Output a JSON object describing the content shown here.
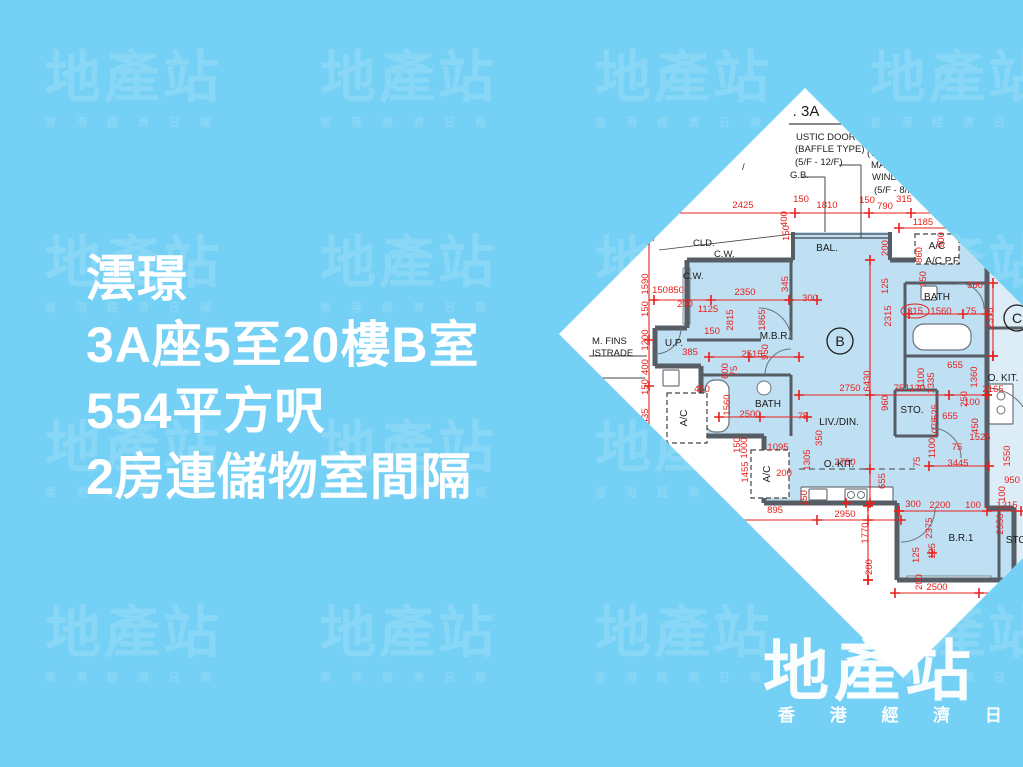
{
  "page": {
    "bg": "#75d0f5"
  },
  "watermark": {
    "logo": "地產站",
    "subtext": "香港經濟日報",
    "cols": [
      45,
      320,
      595,
      870
    ],
    "rows": [
      50,
      235,
      420,
      605
    ]
  },
  "headline": {
    "lines": [
      "澐璟",
      "3A座5至20樓B室",
      "554平方呎",
      "2房連儲物室間隔"
    ],
    "color": "#ffffff"
  },
  "brand": {
    "logo": "地產站",
    "subtext_spaced": "香 港 經 濟 日 報"
  },
  "floor_plan": {
    "colors": {
      "paper": "#ffffff",
      "unit_fill": "#bfdff2",
      "unitc_fill": "#dcedf8",
      "wall": "#565d64",
      "thin": "#444444",
      "red": "#e8211d",
      "text": "#1c1c1c",
      "fixture_fill": "#ffffff",
      "fixture_stroke": "#6a737a",
      "window_fill": "#e4f2fb"
    },
    "tower_label": ". 3A",
    "notes": [
      [
        "USTIC DOOR",
        237,
        52
      ],
      [
        "(BAFFLE TYPE)",
        236,
        64
      ],
      [
        "(5/F  -  12/F)",
        236,
        77
      ],
      [
        "F..",
        306,
        56
      ],
      [
        "(WIT..",
        308,
        68
      ],
      [
        "MAINTE..",
        312,
        80
      ],
      [
        "WINDOW)",
        313,
        92
      ],
      [
        "(5/F - 8/F)",
        315,
        105
      ],
      [
        "G.B.",
        231,
        90
      ],
      [
        "/",
        183,
        82
      ],
      [
        "CLD.",
        134,
        158
      ],
      [
        "C.W.",
        155,
        169
      ],
      [
        "C.W.",
        124,
        191
      ],
      [
        "M. FINS",
        33,
        256
      ],
      [
        "ISTRADE",
        33,
        268
      ]
    ],
    "room_labels": [
      [
        "BAL.",
        268,
        163,
        0
      ],
      [
        "A/C",
        378,
        161,
        0
      ],
      [
        "A/C P.F.",
        384,
        176,
        0
      ],
      [
        "BATH",
        378,
        212,
        0
      ],
      [
        "M.B.R.",
        216,
        251,
        0
      ],
      [
        "U.P.",
        115,
        258,
        0
      ],
      [
        "BATH",
        209,
        319,
        0
      ],
      [
        "LIV./DIN.",
        280,
        337,
        0
      ],
      [
        "STO.",
        353,
        325,
        0
      ],
      [
        "O. KIT.",
        444,
        293,
        0
      ],
      [
        "O. KIT.",
        280,
        379,
        0
      ],
      [
        "B.R.1",
        402,
        453,
        0
      ],
      [
        "STO",
        457,
        455,
        0
      ],
      [
        "A/C",
        128,
        330,
        1
      ],
      [
        "A/C",
        211,
        386,
        1
      ]
    ],
    "unit_circles": [
      [
        "B",
        281,
        253
      ],
      [
        "C",
        458,
        230
      ]
    ],
    "dims_h": [
      [
        "2425",
        184,
        120
      ],
      [
        "150",
        242,
        114
      ],
      [
        "1810",
        268,
        120
      ],
      [
        "150",
        308,
        115
      ],
      [
        "790",
        326,
        121
      ],
      [
        "315",
        345,
        114
      ],
      [
        "1185",
        364,
        137
      ],
      [
        "150",
        101,
        205
      ],
      [
        "850",
        117,
        205
      ],
      [
        "200",
        126,
        219
      ],
      [
        "1125",
        149,
        224
      ],
      [
        "2350",
        186,
        207
      ],
      [
        "300",
        251,
        213
      ],
      [
        "150",
        153,
        246
      ],
      [
        "385",
        131,
        267
      ],
      [
        "2515",
        193,
        269
      ],
      [
        "450",
        143,
        304
      ],
      [
        "2500",
        191,
        329
      ],
      [
        "75",
        244,
        331
      ],
      [
        "2750",
        291,
        303
      ],
      [
        "75",
        340,
        303
      ],
      [
        "1120",
        356,
        303
      ],
      [
        "655",
        396,
        280
      ],
      [
        "655",
        391,
        331
      ],
      [
        "2165",
        434,
        304
      ],
      [
        "100",
        413,
        317
      ],
      [
        "1525",
        421,
        352
      ],
      [
        "75",
        398,
        362
      ],
      [
        "3445",
        399,
        378
      ],
      [
        "2750",
        286,
        377
      ],
      [
        "1095",
        219,
        362
      ],
      [
        "200",
        225,
        388
      ],
      [
        "895",
        216,
        425
      ],
      [
        "2950",
        286,
        429
      ],
      [
        "300",
        354,
        419
      ],
      [
        "2200",
        381,
        420
      ],
      [
        "100",
        414,
        420
      ],
      [
        "1215",
        448,
        420
      ],
      [
        "950",
        453,
        395
      ],
      [
        "2500",
        378,
        502
      ],
      [
        "315",
        356,
        226
      ],
      [
        "1560",
        382,
        226
      ],
      [
        "75",
        412,
        226
      ],
      [
        "360",
        416,
        200
      ]
    ],
    "dims_v": [
      [
        "400",
        228,
        131
      ],
      [
        "150",
        230,
        145
      ],
      [
        "345",
        229,
        196
      ],
      [
        "900",
        385,
        152
      ],
      [
        "860",
        363,
        167
      ],
      [
        "150",
        367,
        191
      ],
      [
        "1590",
        89,
        196
      ],
      [
        "150",
        89,
        221
      ],
      [
        "1200",
        89,
        252
      ],
      [
        "400",
        89,
        279
      ],
      [
        "150",
        89,
        299
      ],
      [
        "1435",
        89,
        331
      ],
      [
        "2815",
        174,
        232
      ],
      [
        "1865",
        206,
        232
      ],
      [
        "200",
        329,
        160
      ],
      [
        "125",
        329,
        198
      ],
      [
        "2315",
        332,
        228
      ],
      [
        "2375",
        434,
        230
      ],
      [
        "950",
        209,
        264
      ],
      [
        "600",
        169,
        283
      ],
      [
        "75",
        178,
        283
      ],
      [
        "1560",
        171,
        317
      ],
      [
        "150",
        181,
        357
      ],
      [
        "1000",
        188,
        360
      ],
      [
        "1455",
        189,
        384
      ],
      [
        "1305",
        251,
        372
      ],
      [
        "350",
        263,
        350
      ],
      [
        "6430",
        311,
        293
      ],
      [
        "1100",
        365,
        290
      ],
      [
        "1335",
        375,
        295
      ],
      [
        "960",
        329,
        315
      ],
      [
        "525",
        379,
        324
      ],
      [
        "1075",
        379,
        340
      ],
      [
        "1360",
        418,
        289
      ],
      [
        "250",
        408,
        311
      ],
      [
        "450",
        419,
        338
      ],
      [
        "1100",
        376,
        360
      ],
      [
        "75",
        361,
        374
      ],
      [
        "1550",
        451,
        368
      ],
      [
        "100",
        446,
        406
      ],
      [
        "655",
        326,
        393
      ],
      [
        "150",
        248,
        410
      ],
      [
        "1770",
        309,
        445
      ],
      [
        "200",
        313,
        479
      ],
      [
        "2375",
        373,
        440
      ],
      [
        "125",
        376,
        463
      ],
      [
        "2350",
        444,
        436
      ],
      [
        "125",
        360,
        467
      ],
      [
        "200",
        363,
        494
      ]
    ],
    "dim_oval": [
      356,
      226,
      14,
      7
    ],
    "red_lines": [
      [
        100,
        125,
        420,
        125
      ],
      [
        340,
        140,
        410,
        140
      ],
      [
        90,
        152,
        90,
        408
      ],
      [
        95,
        212,
        258,
        212
      ],
      [
        311,
        172,
        311,
        415
      ],
      [
        240,
        307,
        428,
        307
      ],
      [
        160,
        329,
        248,
        329
      ],
      [
        176,
        432,
        342,
        432
      ],
      [
        340,
        423,
        462,
        423
      ],
      [
        336,
        505,
        462,
        505
      ],
      [
        309,
        418,
        309,
        492
      ],
      [
        434,
        195,
        434,
        268
      ],
      [
        150,
        269,
        240,
        269
      ],
      [
        370,
        378,
        430,
        378
      ],
      [
        350,
        226,
        428,
        226
      ]
    ],
    "crosses": [
      [
        236,
        125
      ],
      [
        310,
        125
      ],
      [
        352,
        125
      ],
      [
        388,
        125
      ],
      [
        152,
        212
      ],
      [
        230,
        212
      ],
      [
        311,
        307
      ],
      [
        390,
        307
      ],
      [
        428,
        307
      ],
      [
        258,
        432
      ],
      [
        309,
        432
      ],
      [
        190,
        269
      ],
      [
        404,
        226
      ],
      [
        311,
        381
      ],
      [
        434,
        268
      ],
      [
        309,
        492
      ],
      [
        373,
        465
      ],
      [
        340,
        423
      ],
      [
        428,
        423
      ],
      [
        90,
        252
      ],
      [
        90,
        298
      ],
      [
        90,
        350
      ],
      [
        201,
        329
      ],
      [
        287,
        415
      ],
      [
        420,
        505
      ]
    ],
    "unit_polygon": "234,144 331,144 331,172 360,172 360,152 428,152 428,420 455,420 455,492 338,492 338,415 205,415 205,348 142,348 142,278 96,278 96,240 128,240 128,172 234,172",
    "unitc_rects": [
      [
        428,
        150,
        150,
        272
      ],
      [
        455,
        420,
        120,
        74
      ]
    ],
    "walls": [
      [
        128,
        172,
        234,
        172,
        5
      ],
      [
        331,
        172,
        360,
        172,
        5
      ],
      [
        234,
        144,
        234,
        172,
        4
      ],
      [
        331,
        144,
        331,
        172,
        4
      ],
      [
        360,
        152,
        360,
        172,
        5
      ],
      [
        360,
        152,
        428,
        152,
        5
      ],
      [
        428,
        152,
        428,
        420,
        5
      ],
      [
        128,
        172,
        128,
        240,
        5
      ],
      [
        128,
        240,
        96,
        240,
        5
      ],
      [
        96,
        240,
        96,
        278,
        5
      ],
      [
        96,
        278,
        142,
        278,
        5
      ],
      [
        142,
        278,
        142,
        348,
        5
      ],
      [
        142,
        348,
        205,
        348,
        5
      ],
      [
        205,
        348,
        205,
        415,
        5
      ],
      [
        205,
        415,
        338,
        415,
        5
      ],
      [
        338,
        415,
        338,
        492,
        5
      ],
      [
        338,
        492,
        455,
        492,
        5
      ],
      [
        455,
        420,
        455,
        492,
        5
      ],
      [
        428,
        420,
        455,
        420,
        5
      ],
      [
        232,
        172,
        232,
        252,
        3
      ],
      [
        128,
        252,
        202,
        252,
        3
      ],
      [
        142,
        287,
        232,
        287,
        3
      ],
      [
        232,
        287,
        232,
        348,
        3
      ],
      [
        346,
        195,
        428,
        195,
        3
      ],
      [
        346,
        195,
        346,
        268,
        3
      ],
      [
        346,
        268,
        428,
        268,
        3
      ],
      [
        346,
        268,
        346,
        300,
        3
      ],
      [
        336,
        302,
        378,
        302,
        3
      ],
      [
        378,
        302,
        378,
        348,
        3
      ],
      [
        336,
        302,
        336,
        348,
        3
      ],
      [
        336,
        348,
        378,
        348,
        3
      ],
      [
        428,
        240,
        540,
        240,
        3
      ],
      [
        466,
        152,
        466,
        240,
        3
      ],
      [
        440,
        420,
        440,
        492,
        3
      ],
      [
        234,
        146,
        331,
        146,
        1.5
      ],
      [
        234,
        150,
        331,
        150,
        1.5
      ]
    ],
    "leader_lines": [
      [
        30,
        268,
        88,
        268,
        1
      ],
      [
        30,
        290,
        86,
        290,
        1
      ],
      [
        243,
        89,
        266,
        89,
        1
      ],
      [
        266,
        89,
        266,
        144,
        1
      ],
      [
        280,
        77,
        302,
        77,
        1
      ],
      [
        302,
        77,
        302,
        150,
        1
      ],
      [
        230,
        36,
        296,
        36,
        1.2
      ],
      [
        100,
        162,
        234,
        146,
        0.8
      ]
    ],
    "dashed_line": [
      240,
      381,
      360,
      381
    ],
    "ac_boxes": [
      [
        356,
        146,
        44,
        30
      ],
      [
        108,
        305,
        40,
        50
      ],
      [
        192,
        362,
        38,
        48
      ]
    ],
    "fixture_rects": [
      [
        146,
        292,
        24,
        52,
        10
      ],
      [
        354,
        236,
        58,
        26,
        11
      ],
      [
        242,
        399,
        92,
        15,
        1
      ],
      [
        286,
        401,
        22,
        12,
        1
      ],
      [
        250,
        401,
        18,
        11,
        1
      ],
      [
        362,
        198,
        16,
        14,
        2
      ],
      [
        430,
        296,
        24,
        40,
        1
      ],
      [
        104,
        282,
        16,
        16,
        1
      ]
    ],
    "fixture_circles": [
      [
        205,
        300,
        7
      ],
      [
        292,
        407,
        3.5
      ],
      [
        302,
        407,
        3.5
      ],
      [
        442,
        308,
        4
      ],
      [
        442,
        322,
        4
      ]
    ],
    "window_rects": [
      [
        124,
        180,
        7,
        56
      ],
      [
        348,
        488,
        84,
        6
      ]
    ],
    "door_arcs": [
      "M 200,220 A 32 32 0 0 1 232,252",
      "M 232,261 A 26 26 0 0 0 206,287",
      "M 376,420 A 34 34 0 0 1 342,454",
      "M 372,340 A 30 30 0 0 1 402,370",
      "M 122,240 A 26 26 0 0 1 96,266",
      "M 428,300 A 44 44 0 0 1 472,344",
      "M 425,221 A 26 26 0 0 0 399,195"
    ],
    "underline_3a": [
      230,
      36,
      296,
      36
    ],
    "tower_label_pos": [
      247,
      28
    ]
  }
}
